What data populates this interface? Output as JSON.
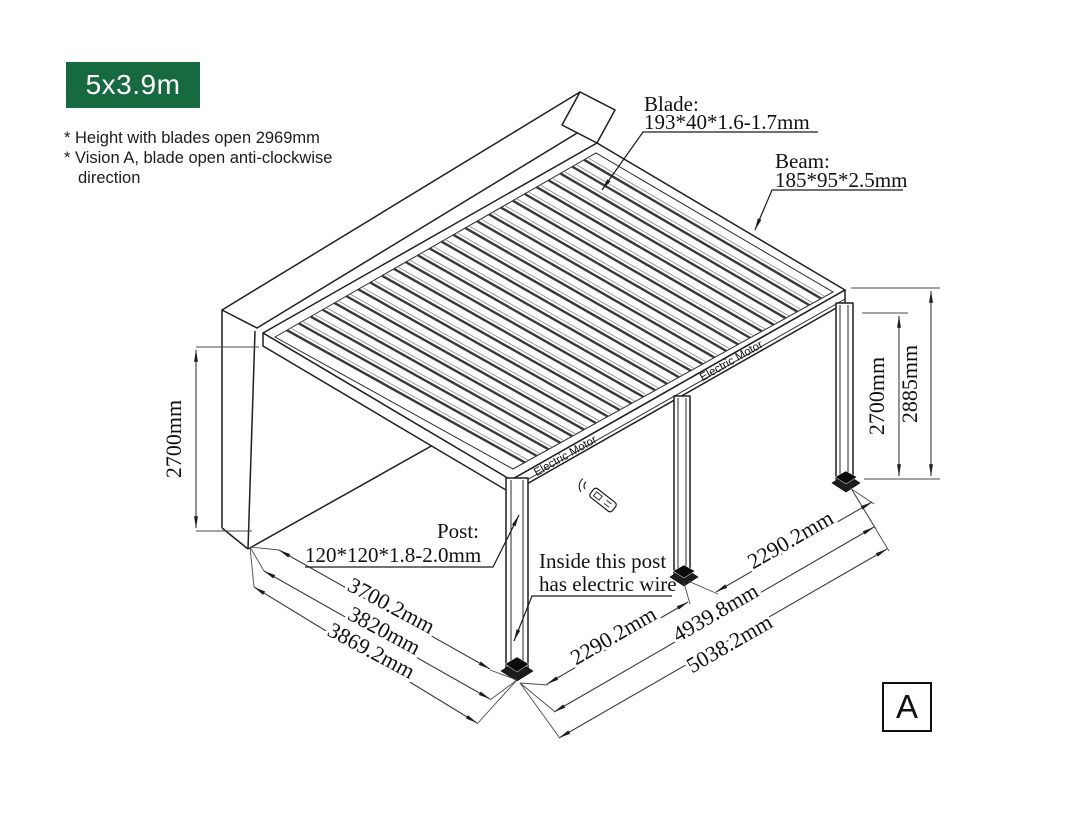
{
  "badge": {
    "label": "5x3.9m",
    "bg_color": "#17693f"
  },
  "notes": {
    "line1": "* Height with blades open 2969mm",
    "line2": "* Vision A, blade open anti-clockwise",
    "line3": "direction"
  },
  "callouts": {
    "blade": {
      "title": "Blade:",
      "spec": "193*40*1.6-1.7mm"
    },
    "beam": {
      "title": "Beam:",
      "spec": "185*95*2.5mm"
    },
    "post": {
      "title": "Post:",
      "spec": "120*120*1.8-2.0mm"
    },
    "wire": {
      "line1": "Inside this post",
      "line2": "has electric wire"
    }
  },
  "dimensions": {
    "wall_height": "2700mm",
    "post_height": "2700mm",
    "total_height": "2885mm",
    "depth_inner": "3700.2mm",
    "depth_mid": "3820mm",
    "depth_outer": "3869.2mm",
    "front_bay": "2290.2mm",
    "side_bay": "2290.2mm",
    "post_span": "4939.8mm",
    "total_length": "5038.2mm"
  },
  "structure": {
    "motor_label_left": "Electric Motor",
    "motor_label_right": "Electric Motor"
  },
  "view_marker": {
    "label": "A"
  }
}
